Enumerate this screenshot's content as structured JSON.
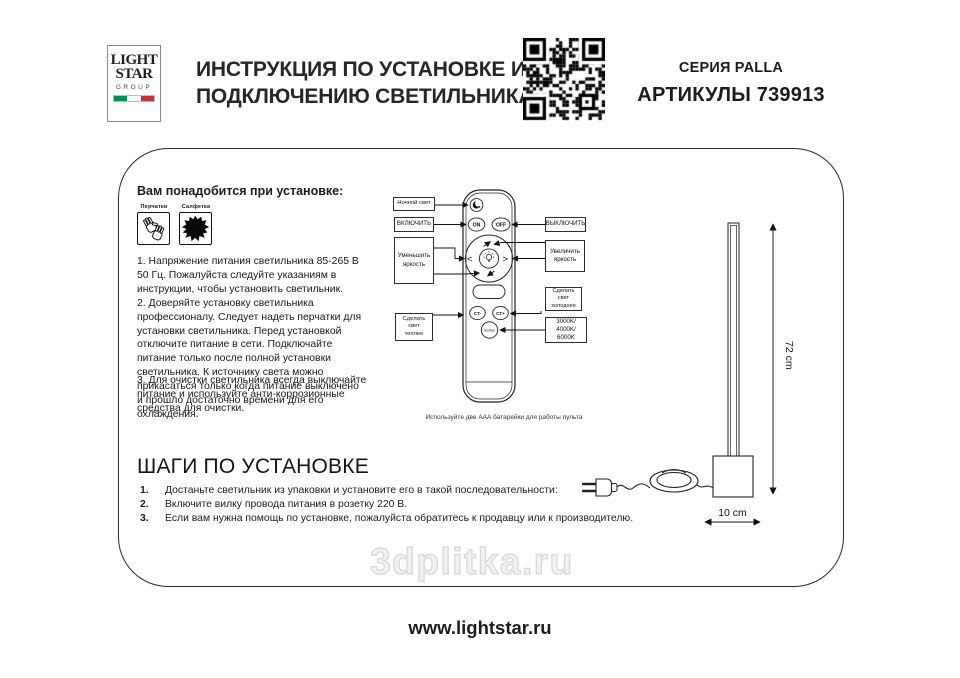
{
  "header": {
    "logo": {
      "line1": "LIGHT",
      "line2": "STAR",
      "line3": "GROUP",
      "flag_colors": [
        "#009246",
        "#ffffff",
        "#ce2b37"
      ]
    },
    "title": [
      "ИНСТРУКЦИЯ ПО УСТАНОВКЕ И",
      "ПОДКЛЮЧЕНИЮ СВЕТИЛЬНИКА"
    ],
    "series": "СЕРИЯ PALLA",
    "articles": "АРТИКУЛЫ 739913"
  },
  "requirements": {
    "heading": "Вам понадобится при установке:",
    "items": [
      {
        "label": "Перчатки",
        "icon": "gloves-icon"
      },
      {
        "label": "Салфетка",
        "icon": "napkin-icon"
      }
    ],
    "notes": [
      "1. Напряжение питания светильника 85-265 В 50 Гц. Пожалуйста следуйте указаниям в инструкции, чтобы установить светильник.",
      "2. Доверяйте установку светильника профессионалу. Следует надеть перчатки для установки светильника. Перед установкой отключите питание в сети. Подключайте питание только после полной установки светильника. К источнику света можно прикасаться только когда питание выключено и прошло достаточно времени для его охлаждения.",
      "3. Для очистки светильника всегда выключайте питание и используйте анти-коррозионные средства для очистки."
    ]
  },
  "remote": {
    "callouts": {
      "night": "Ночной свет",
      "on": "ВКЛЮЧИТЬ",
      "dim": [
        "Уменьшить",
        "яркость"
      ],
      "warm": [
        "Сделать",
        "свет",
        "теплее"
      ],
      "off": "ВЫКЛЮЧИТЬ",
      "bright": [
        "Увеличить",
        "яркость"
      ],
      "cold": [
        "Сделать",
        "свет",
        "холоднее"
      ],
      "kelvin": [
        "3000K/",
        "4000K/",
        "6000K"
      ]
    },
    "buttons": {
      "on": "ON",
      "off": "OFF",
      "ct_minus": "CT-",
      "ct_plus": "CT+",
      "section": "Section"
    },
    "battery_note": "Используйте две ААА батарейки для работы пульта"
  },
  "lamp": {
    "height": "72 cm",
    "width": "10 cm"
  },
  "steps": {
    "heading": "ШАГИ ПО УСТАНОВКЕ",
    "items": [
      {
        "num": "1.",
        "text": "Достаньте светильник из упаковки и установите его в такой последовательности:"
      },
      {
        "num": "2.",
        "text": "Включите вилку провода питания в розетку 220 В."
      },
      {
        "num": "3.",
        "text": "Если вам нужна помощь по установке, пожалуйста обратитесь к продавцу или к производителю."
      }
    ]
  },
  "footer": {
    "watermark": "3dplitka.ru",
    "website": "www.lightstar.ru"
  }
}
